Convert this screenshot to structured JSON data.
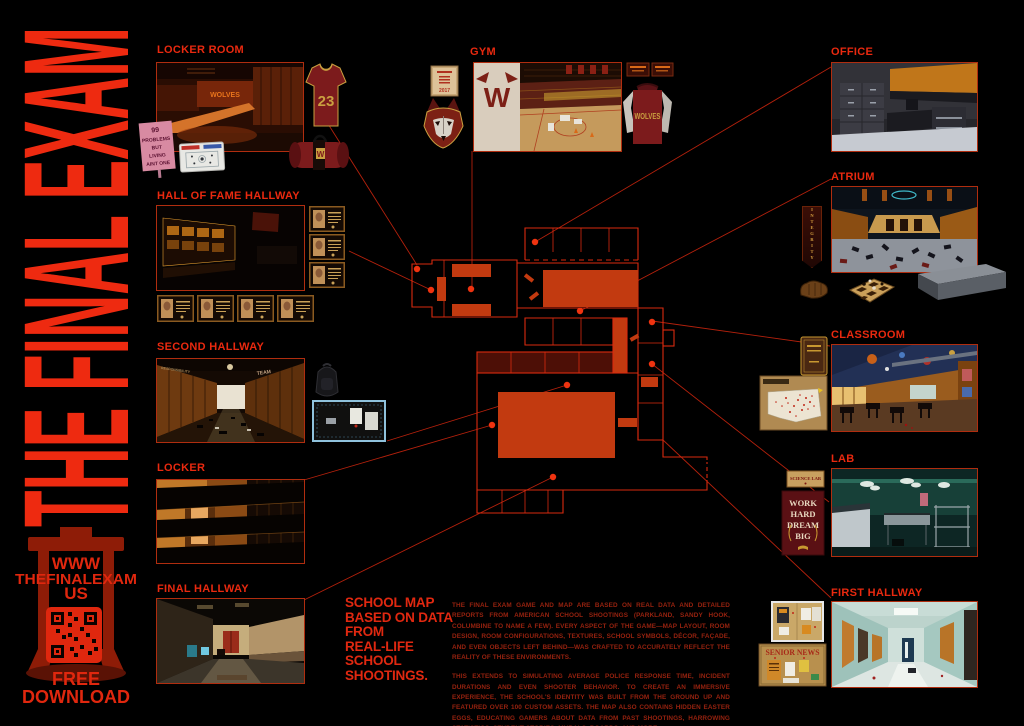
{
  "poster": {
    "title": "THE FINAL EXAM",
    "url_line1": "WWW",
    "url_line2": "THEFINALEXAM",
    "url_line3": "US",
    "download_line1": "FREE",
    "download_line2": "DOWNLOAD"
  },
  "sections": {
    "locker_room": {
      "label": "LOCKER ROOM"
    },
    "hall_of_fame": {
      "label": "HALL OF FAME HALLWAY"
    },
    "second_hallway": {
      "label": "SECOND HALLWAY"
    },
    "locker": {
      "label": "LOCKER"
    },
    "final_hallway": {
      "label": "FINAL HALLWAY"
    },
    "gym": {
      "label": "GYM"
    },
    "office": {
      "label": "OFFICE"
    },
    "atrium": {
      "label": "ATRIUM"
    },
    "classroom": {
      "label": "CLASSROOM"
    },
    "lab": {
      "label": "LAB"
    },
    "first_hallway": {
      "label": "FIRST HALLWAY"
    }
  },
  "tagline": {
    "lines": [
      "SCHOOL MAP",
      "BASED ON DATA",
      "FROM",
      "REAL-LIFE",
      "SCHOOL",
      "SHOOTINGS."
    ]
  },
  "body": {
    "p1": "THE FINAL EXAM GAME AND MAP ARE BASED ON REAL DATA AND DETAILED REPORTS FROM AMERICAN SCHOOL SHOOTINGS (PARKLAND, SANDY HOOK, COLUMBINE TO NAME A FEW). EVERY ASPECT OF THE GAME—MAP LAYOUT, ROOM DESIGN, ROOM CONFIGURATIONS, TEXTURES, SCHOOL SYMBOLS, DÉCOR, FAÇADE, AND EVEN OBJECTS LEFT BEHIND—WAS CRAFTED TO ACCURATELY REFLECT THE REALITY OF THESE ENVIRONMENTS.",
    "p2": "THIS EXTENDS TO SIMULATING AVERAGE POLICE RESPONSE TIME, INCIDENT DURATIONS AND EVEN SHOOTER BEHAVIOR. TO CREATE AN IMMERSIVE EXPERIENCE, THE SCHOOL'S IDENTITY WAS BUILT FROM THE GROUND UP AND FEATURED OVER 100 CUSTOM ASSETS. THE MAP ALSO CONTAINS HIDDEN EASTER EGGS, EDUCATING GAMERS ABOUT DATA FROM PAST SHOOTINGS, HARROWING STATISTICS, STUDENT STORIES, MURALS, BOARDS, AND MORE."
  },
  "props": {
    "sign_lines": [
      "99",
      "PROBLEMS",
      "BUT",
      "LIVING",
      "AINT ONE"
    ],
    "jersey_number": "23",
    "locker_room_wall_text": "WOLVES",
    "gym_wall_letter": "W",
    "certificate_year": "2017",
    "sweatshirt_text": "WOLVES",
    "wall_word_left": "RESPONSIBILITY",
    "wall_word_right": "TEAM",
    "integrity_banner": "INTEGRITY",
    "science_lab_sign": "SCIENCE LAB",
    "motivation_poster_lines": [
      "WORK",
      "HARD",
      "DREAM",
      "BIG"
    ],
    "senior_news_title": "SENIOR NEWS"
  },
  "colors": {
    "accent": "#e8280f",
    "body_text": "#96220f",
    "map_bright_room": "#c23a10",
    "map_dark_room": "#4d0f06",
    "background": "#000000"
  }
}
